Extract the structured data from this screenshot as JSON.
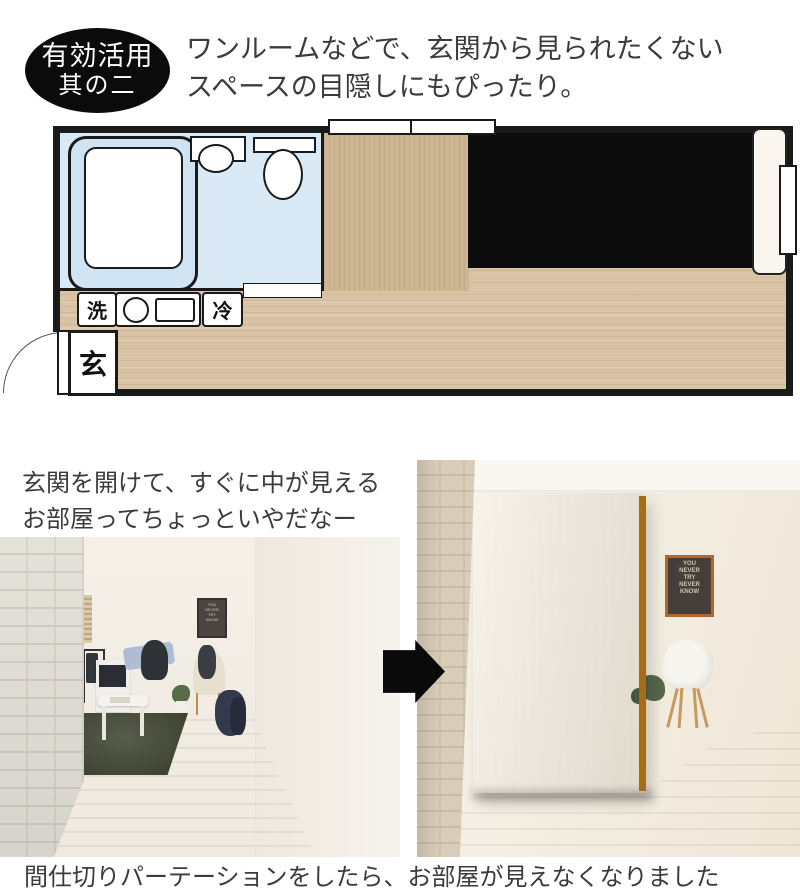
{
  "badge": {
    "line1": "有効活用",
    "line2": "其の二"
  },
  "heading": {
    "line1": "ワンルームなどで、玄関から見られたくない",
    "line2": "スペースの目隠しにもぴったり。"
  },
  "floorplan": {
    "labels": {
      "washer": "洗",
      "fridge": "冷",
      "entrance": "玄"
    }
  },
  "caption": {
    "line1": "玄関を開けて、すぐに中が見える",
    "line2": "お部屋ってちょっといやだなー"
  },
  "bottom_caption": "間仕切りパーテーションをしたら、お部屋が見えなくなりました",
  "poster": {
    "lines": [
      "YOU",
      "NEVER",
      "TRY",
      "NEVER",
      "KNOW"
    ]
  },
  "colors": {
    "badge_bg": "#0b0b0b",
    "plan_wood": "#d8c3a5",
    "bathroom_blue": "#d9e9f5",
    "partition_zone": "#0c0c0c",
    "partition_orange": "#cc8722",
    "rug_green": "#454a36",
    "arrow": "#0a0a0a"
  }
}
